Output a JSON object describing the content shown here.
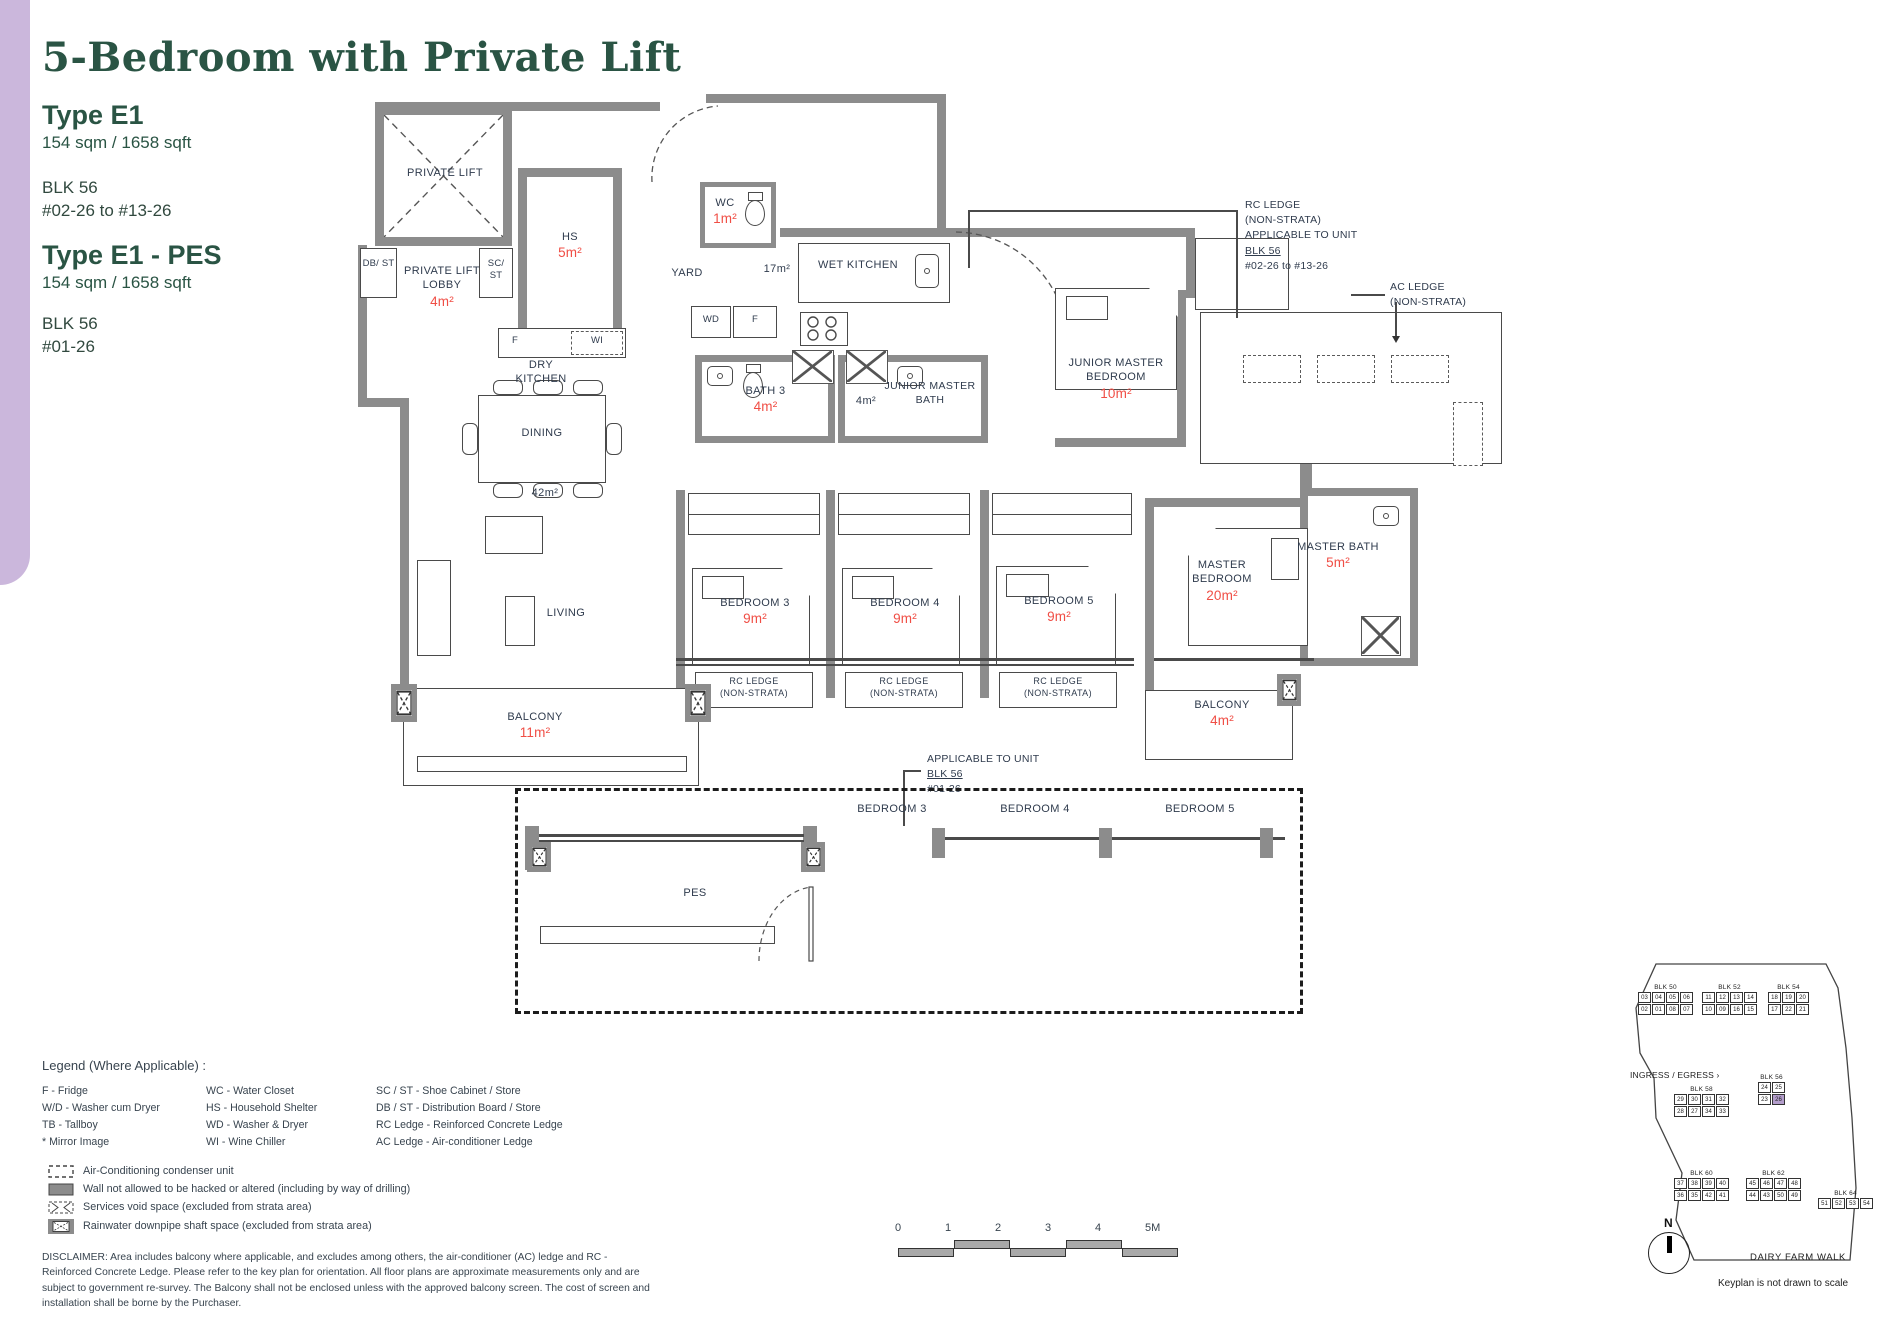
{
  "header": {
    "title": "5-Bedroom with Private Lift",
    "type1": {
      "name": "Type E1",
      "area": "154 sqm / 1658 sqft",
      "blk": "BLK 56",
      "units": "#02-26 to #13-26"
    },
    "type2": {
      "name": "Type E1 - PES",
      "area": "154 sqm / 1658 sqft",
      "blk": "BLK 56",
      "units": "#01-26"
    }
  },
  "plan": {
    "private_lift": "PRIVATE LIFT",
    "hs": "HS",
    "hs_area": "5m²",
    "wc": "WC",
    "wc_area": "1m²",
    "yard": "YARD",
    "yard_area": "17m²",
    "wet_kitchen": "WET KITCHEN",
    "db_st": "DB/ ST",
    "sc_st": "SC/ ST",
    "lobby": "PRIVATE LIFT LOBBY",
    "lobby_area": "4m²",
    "f": "F",
    "wi": "WI",
    "wd": "WD",
    "f2": "F",
    "dry_kitchen": "DRY KITCHEN",
    "dining": "DINING",
    "dining_area": "42m²",
    "bath3": "BATH 3",
    "bath3_area": "4m²",
    "jm_bath": "JUNIOR MASTER BATH",
    "jm_bath_area": "4m²",
    "jm_bed": "JUNIOR MASTER BEDROOM",
    "jm_bed_area": "10m²",
    "bedroom3": "BEDROOM 3",
    "bedroom3_area": "9m²",
    "bedroom4": "BEDROOM 4",
    "bedroom4_area": "9m²",
    "bedroom5": "BEDROOM 5",
    "bedroom5_area": "9m²",
    "master_bed": "MASTER BEDROOM",
    "master_bed_area": "20m²",
    "master_bath": "MASTER BATH",
    "master_bath_area": "5m²",
    "living": "LIVING",
    "balcony": "BALCONY",
    "balcony_area": "11m²",
    "balcony2": "BALCONY",
    "balcony2_area": "4m²",
    "rc_ledge_l1": "RC LEDGE",
    "rc_ledge_l2": "(NON-STRATA)",
    "pes": "PES",
    "pes_bedroom3": "BEDROOM 3",
    "pes_bedroom4": "BEDROOM 4",
    "pes_bedroom5": "BEDROOM 5",
    "rc_note": {
      "l1": "RC LEDGE",
      "l2": "(NON-STRATA)",
      "l3": "APPLICABLE TO UNIT",
      "l4": "BLK 56",
      "l5": "#02-26 to #13-26"
    },
    "ac_note": {
      "l1": "AC LEDGE",
      "l2": "(NON-STRATA)"
    },
    "app_note": {
      "l1": "APPLICABLE TO UNIT",
      "l2": "BLK 56",
      "l3": "#01-26"
    }
  },
  "legend": {
    "title": "Legend (Where Applicable) :",
    "col1": [
      "F - Fridge",
      "W/D - Washer cum Dryer",
      "TB - Tallboy",
      "* Mirror Image"
    ],
    "col2": [
      "WC - Water Closet",
      "HS - Household Shelter",
      "WD - Washer & Dryer",
      "WI  - Wine Chiller"
    ],
    "col3": [
      "SC / ST - Shoe Cabinet / Store",
      "DB / ST - Distribution Board / Store",
      "RC Ledge - Reinforced Concrete Ledge",
      "AC Ledge - Air-conditioner Ledge"
    ],
    "sym1": "Air-Conditioning condenser unit",
    "sym2": "Wall not allowed to be hacked or altered (including by way of drilling)",
    "sym3": "Services void space (excluded from strata area)",
    "sym4": "Rainwater downpipe shaft space (excluded from strata area)"
  },
  "disclaimer": "DISCLAIMER: Area includes balcony where applicable, and excludes among others, the air-conditioner (AC) ledge and RC - Reinforced Concrete Ledge. Please refer to the key plan for orientation. All floor plans are approximate measurements only and are subject to government re-survey. The Balcony shall not be enclosed unless with the approved balcony screen. The cost of screen and installation shall be borne by the Purchaser.",
  "scalebar": {
    "ticks": [
      "0",
      "1",
      "2",
      "3",
      "4",
      "5M"
    ]
  },
  "keyplan": {
    "blocks": {
      "blk50": {
        "name": "BLK 50",
        "row1": [
          "03",
          "04",
          "05",
          "06"
        ],
        "row2": [
          "02",
          "01",
          "08",
          "07"
        ]
      },
      "blk52": {
        "name": "BLK 52",
        "row1": [
          "11",
          "12",
          "13",
          "14"
        ],
        "row2": [
          "10",
          "09",
          "16",
          "15"
        ]
      },
      "blk54": {
        "name": "BLK 54",
        "row1": [
          "18",
          "19",
          "20"
        ],
        "row2": [
          "17",
          "22",
          "21"
        ]
      },
      "blk58": {
        "name": "BLK 58",
        "row1": [
          "29",
          "30",
          "31",
          "32"
        ],
        "row2": [
          "28",
          "27",
          "34",
          "33"
        ]
      },
      "blk56": {
        "name": "BLK 56",
        "row1": [
          "24",
          "25"
        ],
        "row2": [
          "23",
          "26"
        ]
      },
      "blk60": {
        "name": "BLK 60",
        "row1": [
          "37",
          "38",
          "39",
          "40"
        ],
        "row2": [
          "36",
          "35",
          "42",
          "41"
        ]
      },
      "blk62": {
        "name": "BLK 62",
        "row1": [
          "45",
          "46",
          "47",
          "48"
        ],
        "row2": [
          "44",
          "43",
          "50",
          "49"
        ]
      },
      "blk64": {
        "name": "BLK 64",
        "row1": [
          "51",
          "52",
          "53",
          "54"
        ],
        "row2": []
      }
    },
    "highlight_unit": "26",
    "ingress": "INGRESS / EGRESS",
    "road": "DAIRY FARM WALK",
    "note": "Keyplan is not drawn to scale",
    "north": "N"
  },
  "colors": {
    "accent_green": "#2a5444",
    "area_red": "#f04e45",
    "wall_gray": "#8c8c8c",
    "sidebar_lavender": "#cbb7dc",
    "keyplan_highlight": "#b39dcb"
  }
}
